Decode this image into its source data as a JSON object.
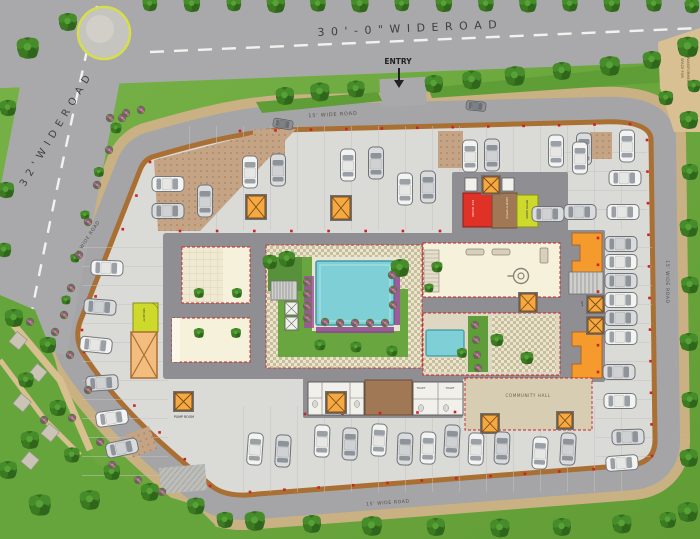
{
  "plan_title": "Ground Floor Site Plan",
  "roads": {
    "top": "3 0 ' - 0 \"   W I D E   R O A D",
    "left": "3 2 '  W I D E  R O A D",
    "inner_top": "15' WIDE ROAD",
    "inner_left": "15' WIDE ROAD",
    "inner_right": "15' WIDE ROAD",
    "inner_bottom": "15' WIDE ROAD",
    "entry": "ENTRY",
    "transformer_line1": "SPACE FOR",
    "transformer_line2": "TRANSFORMER"
  },
  "rooms": {
    "community_hall": "COMMUNITY HALL",
    "pump_room": "PUMP ROOM",
    "electric_room": "ELE. ROOM",
    "society_office": "SOCIETY OFFICE",
    "meter_room": "METER ROOM",
    "security": "SECURITY",
    "toilet_1": "TOILET",
    "toilet_2": "TOILET",
    "lift": "LIFT"
  },
  "colors": {
    "grass": "#6fae3e",
    "road": "#a5a5a7",
    "plot_floor": "#dadad7",
    "boundary": "#a96f33",
    "accent_orange": "#f59a2d",
    "pool": "#7fd0d6",
    "room_red": "#e03127",
    "room_yellow": "#cdd92b",
    "room_brown": "#a07855",
    "hall_cream": "#f6f1da"
  }
}
